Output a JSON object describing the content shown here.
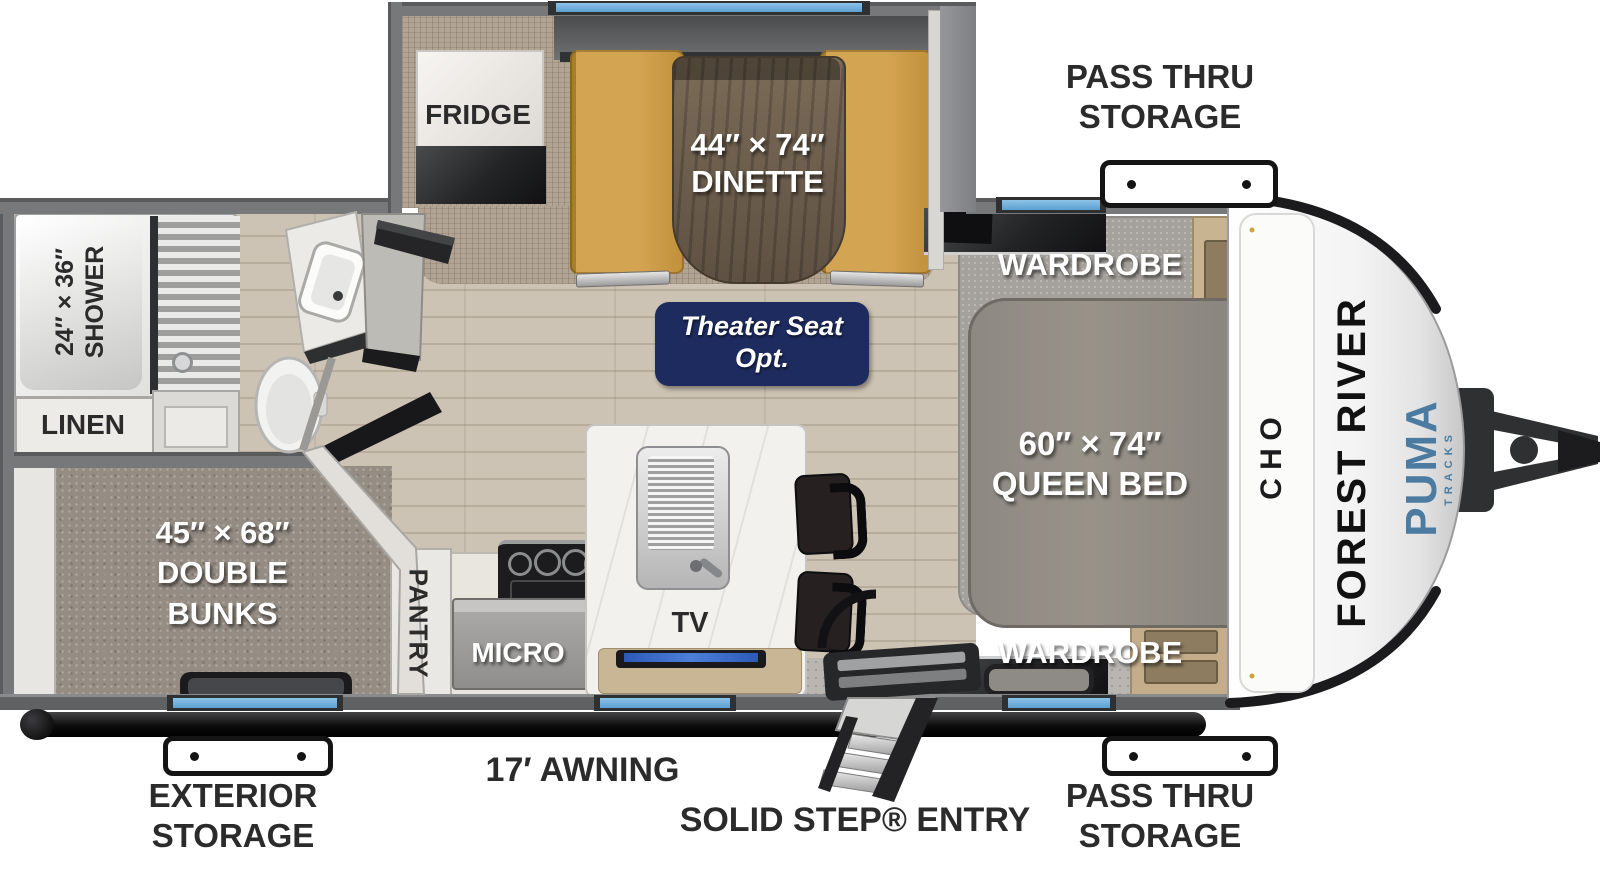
{
  "colors": {
    "window_blue": "#66a9da",
    "theater_navy": "#1d2b5e",
    "puma_blue": "#4b7ba0"
  },
  "exterior": {
    "pass_thru_top": "PASS THRU\nSTORAGE",
    "pass_thru_bottom": "PASS THRU\nSTORAGE",
    "exterior_storage": "EXTERIOR\nSTORAGE",
    "awning": "17′ AWNING",
    "entry": "SOLID STEP® ENTRY"
  },
  "cap": {
    "manufacturer": "FOREST RIVER",
    "model": "PUMA",
    "model_sub": "TRACKS",
    "ohc": [
      "O",
      "H",
      "C"
    ]
  },
  "rooms": {
    "fridge": "FRIDGE",
    "dinette": "44″ × 74″\nDINETTE",
    "theater": "Theater Seat\nOpt.",
    "wardrobe_top": "WARDROBE",
    "wardrobe_bottom": "WARDROBE",
    "queen": "60″ × 74″\nQUEEN BED",
    "bunks": "45″ × 68″\nDOUBLE\nBUNKS",
    "shower": "24″ × 36″\nSHOWER",
    "linen": "LINEN",
    "pantry": "PANTRY",
    "micro": "MICRO",
    "tv": "TV"
  }
}
